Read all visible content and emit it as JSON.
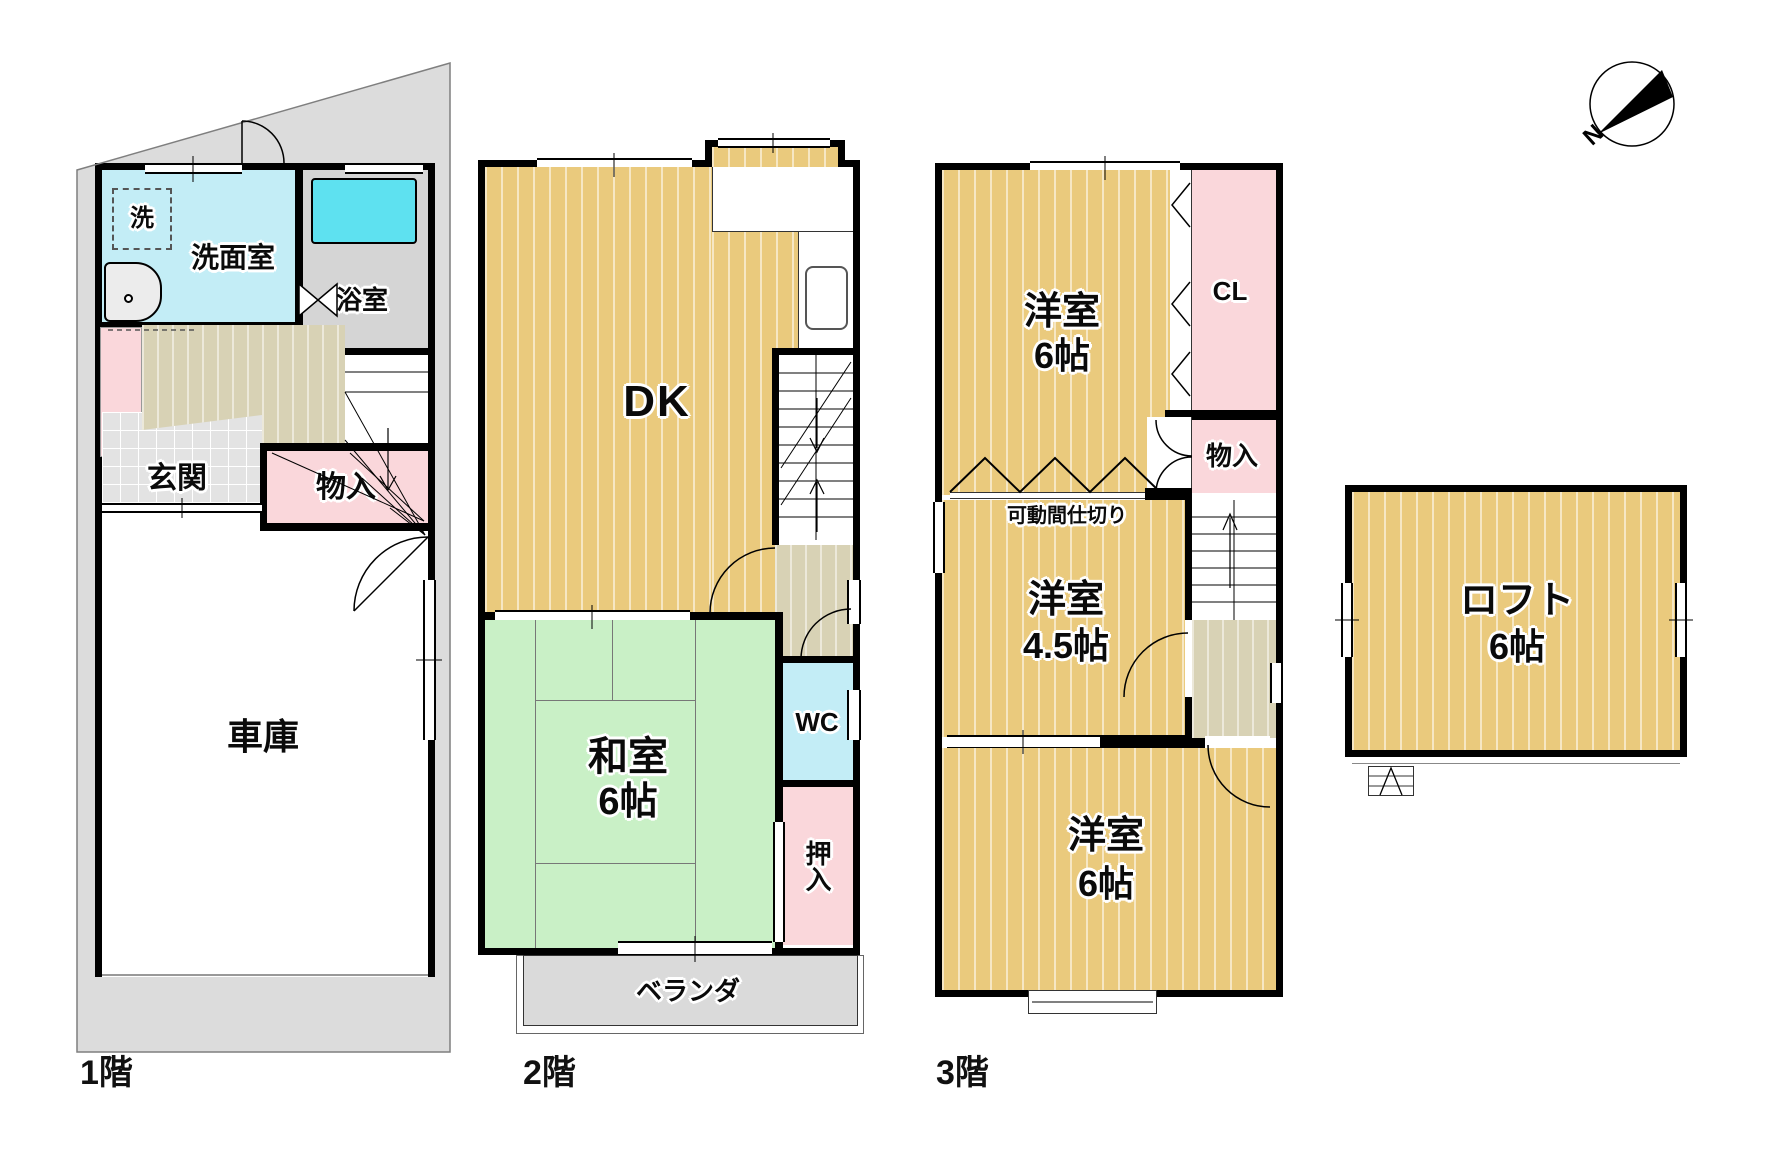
{
  "compass": {
    "north_label": "N"
  },
  "floor1": {
    "floor_label": "1階",
    "washer": "洗",
    "washroom": "洗面室",
    "bathroom": "浴室",
    "entrance": "玄関",
    "storage": "物入",
    "garage": "車庫"
  },
  "floor2": {
    "floor_label": "2階",
    "dk": "DK",
    "japanese_room": "和室",
    "japanese_room_size": "6帖",
    "wc": "WC",
    "closet": "押入",
    "veranda": "ベランダ"
  },
  "floor3": {
    "floor_label": "3階",
    "western_room_top": "洋室",
    "western_room_top_size": "6帖",
    "closet_cl": "CL",
    "storage": "物入",
    "movable_partition": "可動間仕切り",
    "western_room_mid": "洋室",
    "western_room_mid_size": "4.5帖",
    "western_room_bottom": "洋室",
    "western_room_bottom_size": "6帖"
  },
  "loft": {
    "room": "ロフト",
    "room_size": "6帖"
  },
  "colors": {
    "wood_floor": "#EACA7D",
    "tatami_green": "#C9F0C6",
    "water_cyan": "#C3EDF6",
    "bathtub_cyan": "#5EE1F0",
    "closet_pink": "#FAD7DB",
    "hall_floor": "#D8D2B5",
    "site_gray": "#DCDCDC",
    "bathroom_gray": "#D5D5D5",
    "veranda_gray": "#DADADA",
    "wall_black": "#000000"
  }
}
